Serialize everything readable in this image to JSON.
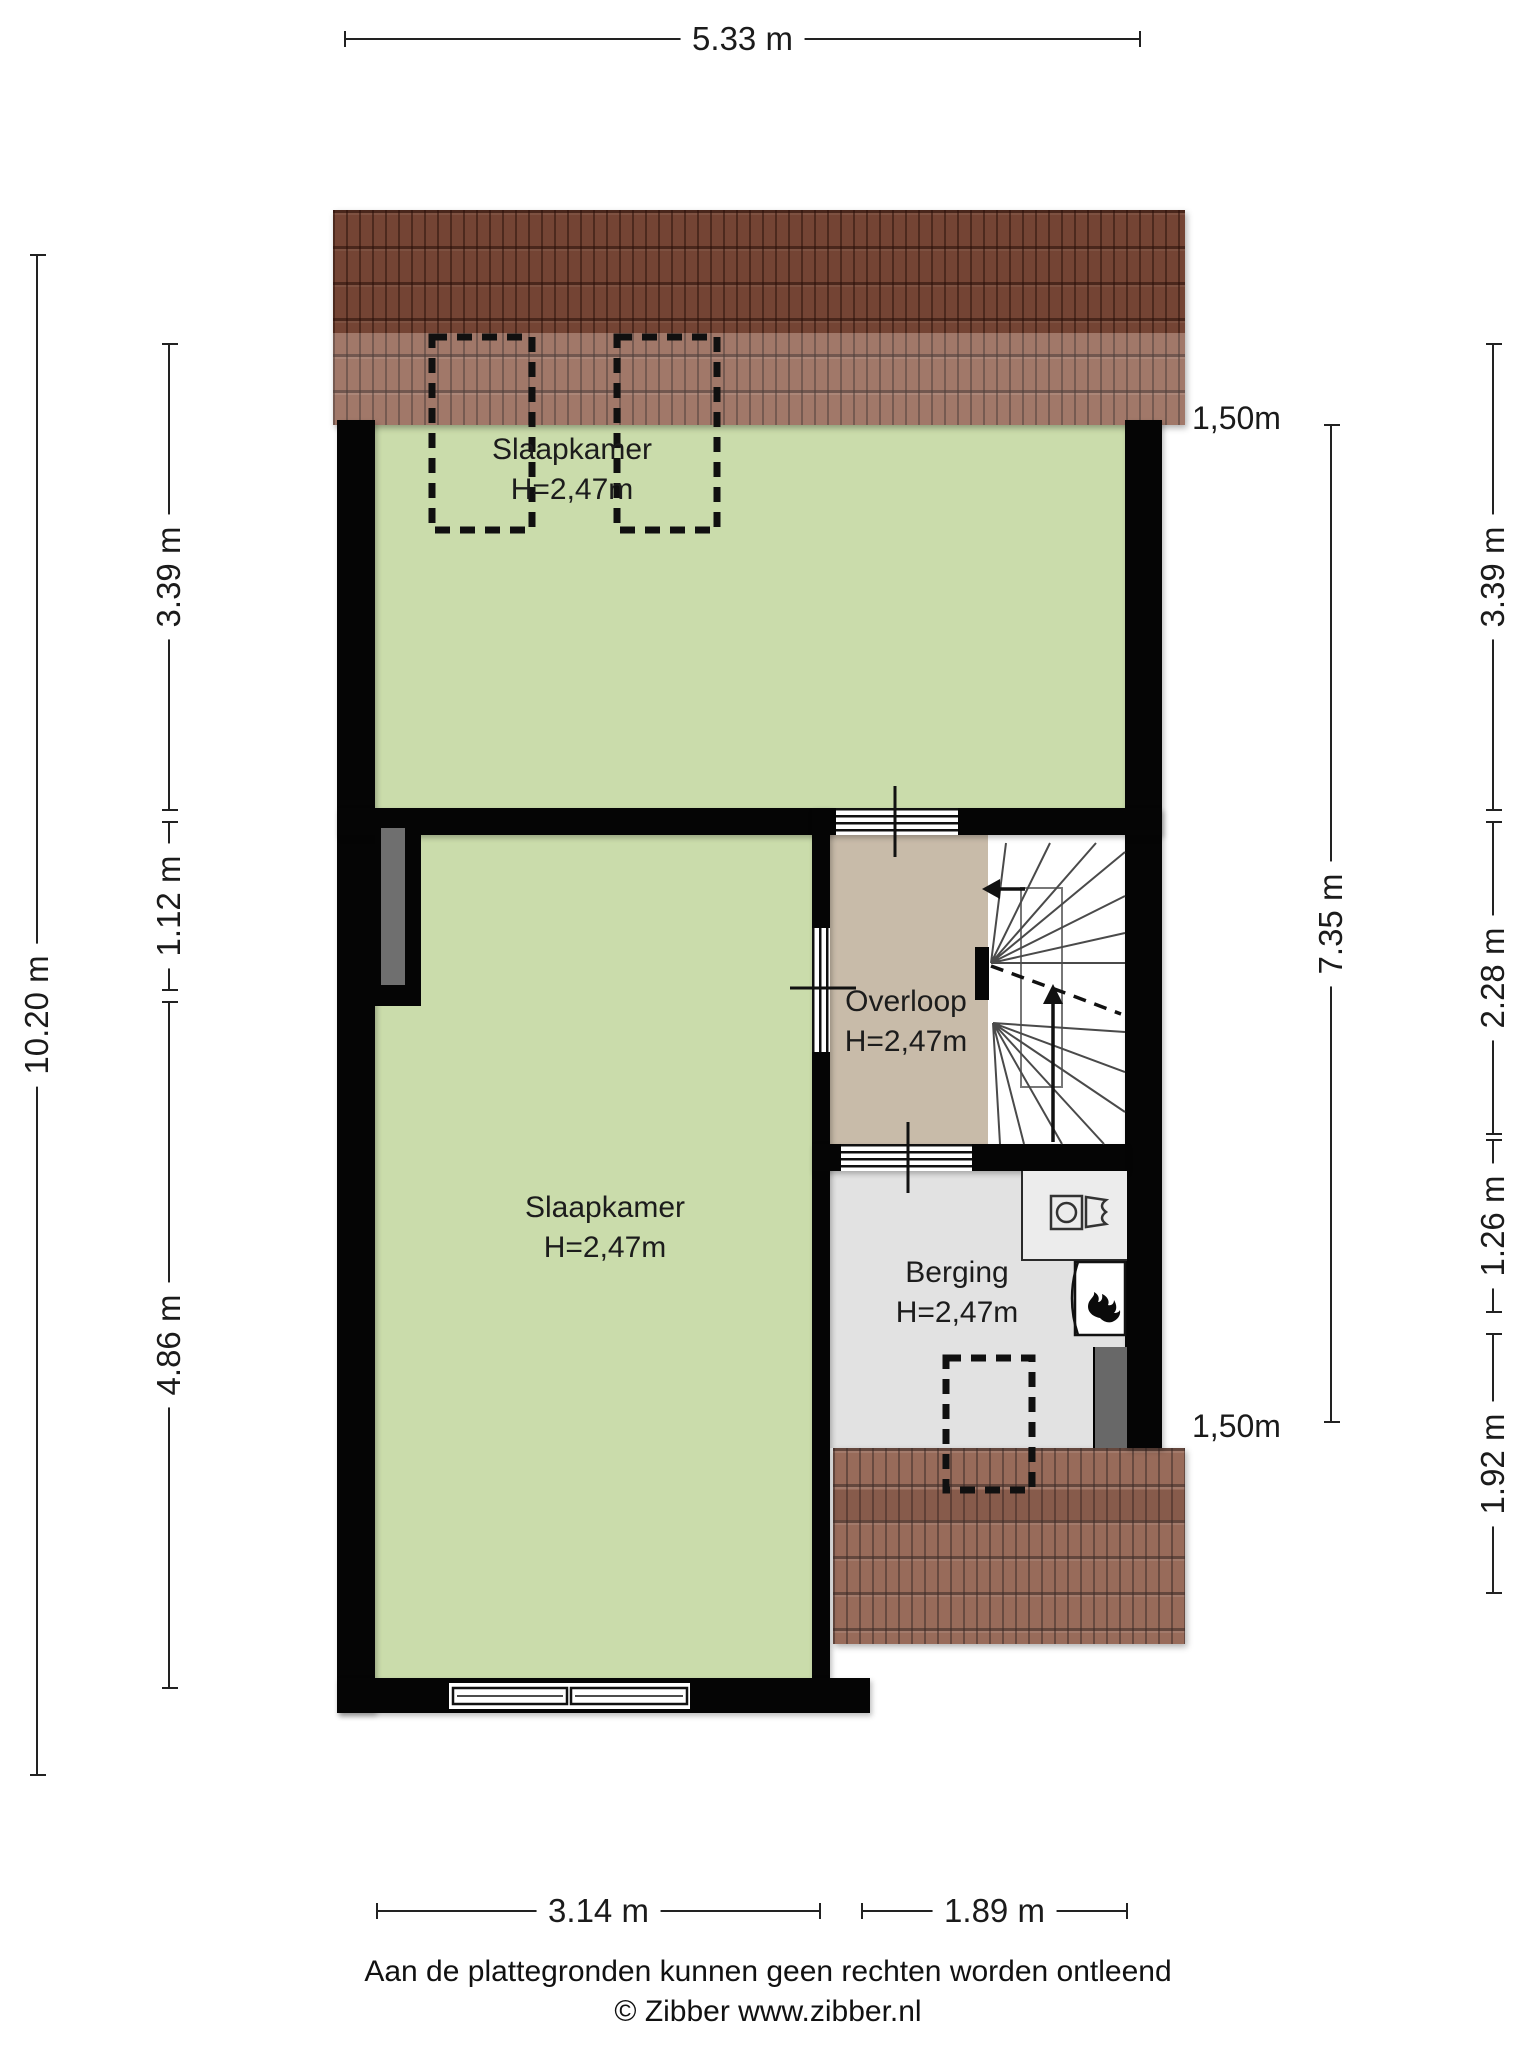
{
  "rooms": [
    {
      "name": "Slaapkamer",
      "height": "H=2,47m"
    },
    {
      "name": "Slaapkamer",
      "height": "H=2,47m"
    },
    {
      "name": "Overloop",
      "height": "H=2,47m"
    },
    {
      "name": "Berging",
      "height": "H=2,47m"
    }
  ],
  "dimensions": {
    "top_width": "5.33 m",
    "left_total": "10.20 m",
    "left_segments": [
      "3.39 m",
      "1.12 m",
      "4.86 m"
    ],
    "right_inner_total": "7.35 m",
    "right_segments": [
      "3.39 m",
      "2.28 m",
      "1.26 m",
      "1.92 m"
    ],
    "bottom_segments": [
      "3.14 m",
      "1.89 m"
    ],
    "roof_height_top": "1,50m",
    "roof_height_bottom": "1,50m"
  },
  "footer": {
    "disclaimer": "Aan de plattegronden kunnen geen rechten worden ontleend",
    "copyright": "© Zibber www.zibber.nl"
  },
  "icons": [
    "stairs",
    "washing-machine",
    "sink",
    "boiler-flame",
    "dormer-window-dashed",
    "window"
  ],
  "colors": {
    "room_green": "#cadcab",
    "landing_tan": "#c8bba9",
    "storage_gray": "#e2e2e2",
    "wall_black": "#050505",
    "roof_brown": "#8a5744"
  }
}
